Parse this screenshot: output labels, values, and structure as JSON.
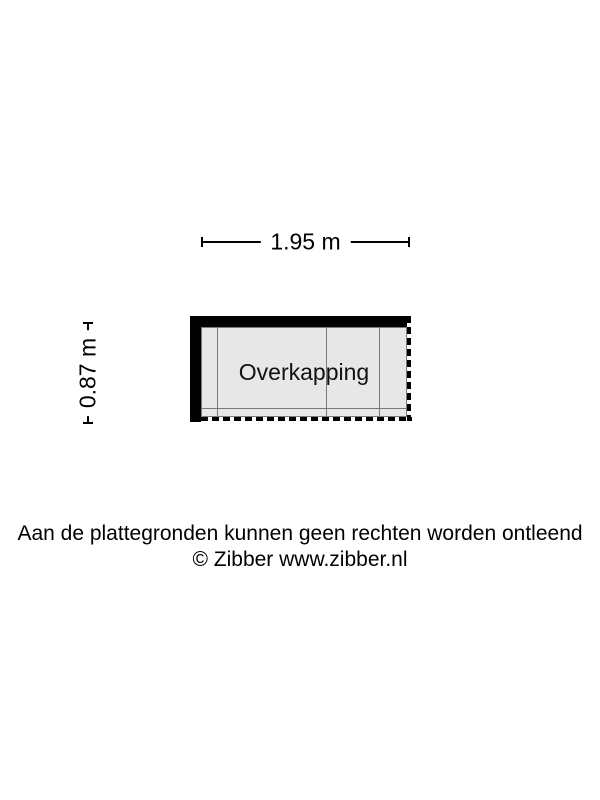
{
  "floorplan": {
    "room_label": "Overkapping",
    "dimensions": {
      "width": "1.95 m",
      "height": "0.87 m"
    },
    "colors": {
      "background": "#ffffff",
      "wall": "#000000",
      "room_fill": "#e7e7e7",
      "grid_line": "#7b7b7b",
      "dimension_line": "#000000",
      "text": "#000000"
    }
  },
  "footer": {
    "disclaimer": "Aan de plattegronden kunnen geen rechten worden ontleend",
    "copyright": "© Zibber www.zibber.nl"
  }
}
